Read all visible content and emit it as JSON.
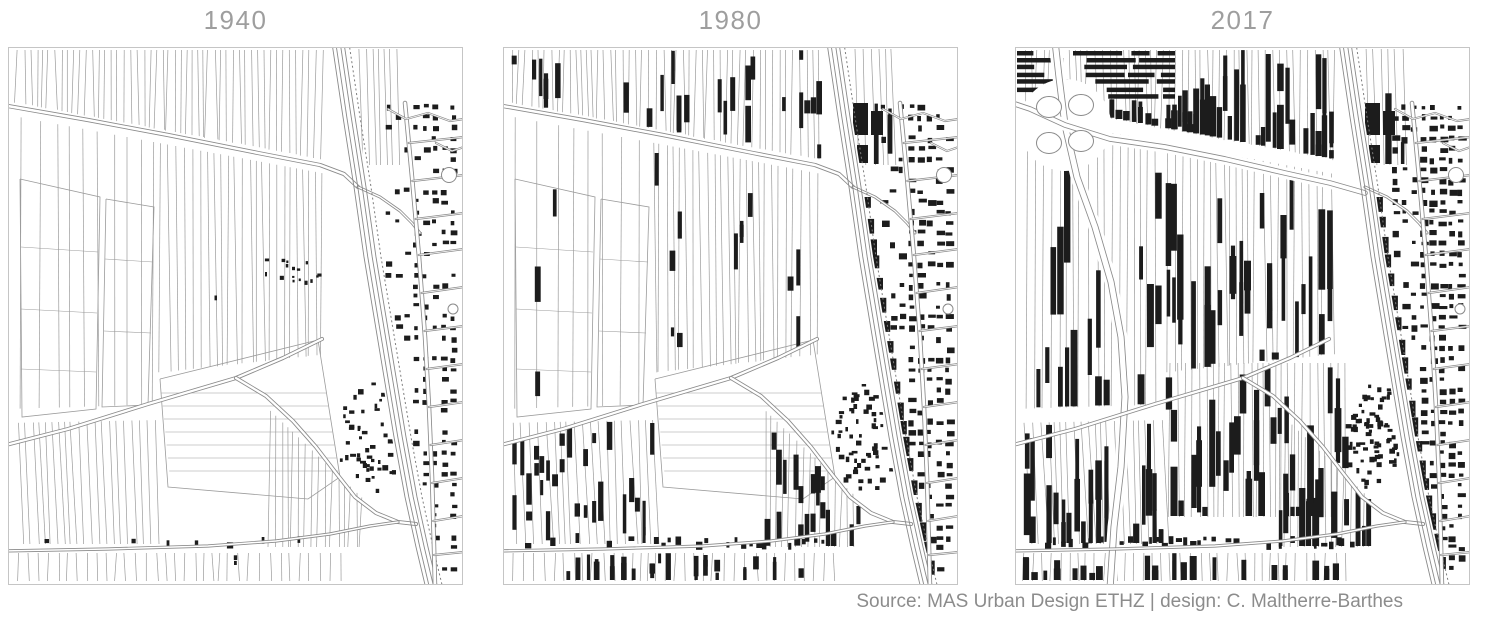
{
  "figure": {
    "panels": [
      {
        "year": "1940",
        "era": 0,
        "seed": 7,
        "built_density": "low",
        "strip_fill_probability": 0.015,
        "house_density": 0.5,
        "has_cloverleaf": false,
        "has_corridor_east_rows": false
      },
      {
        "year": "1980",
        "era": 1,
        "seed": 3,
        "built_density": "medium",
        "strip_fill_probability": 0.55,
        "house_density": 0.68,
        "has_cloverleaf": false,
        "has_corridor_east_rows": true
      },
      {
        "year": "2017",
        "era": 2,
        "seed": 9,
        "built_density": "high",
        "strip_fill_probability": 0.9,
        "house_density": 0.78,
        "has_cloverleaf": true,
        "has_corridor_east_rows": true
      }
    ],
    "caption": "Source: MAS Urban Design ETHZ | design: C. Maltherre-Barthes"
  },
  "colors": {
    "background": "#ffffff",
    "building": "#1c1c1c",
    "parcel_line": "#9b9b9b",
    "road_line": "#8a8a8a",
    "railway_line": "#7d7d7d",
    "panel_border": "#c5c5c5",
    "title_text": "#9e9e9e",
    "caption_text": "#8c8c8c"
  }
}
